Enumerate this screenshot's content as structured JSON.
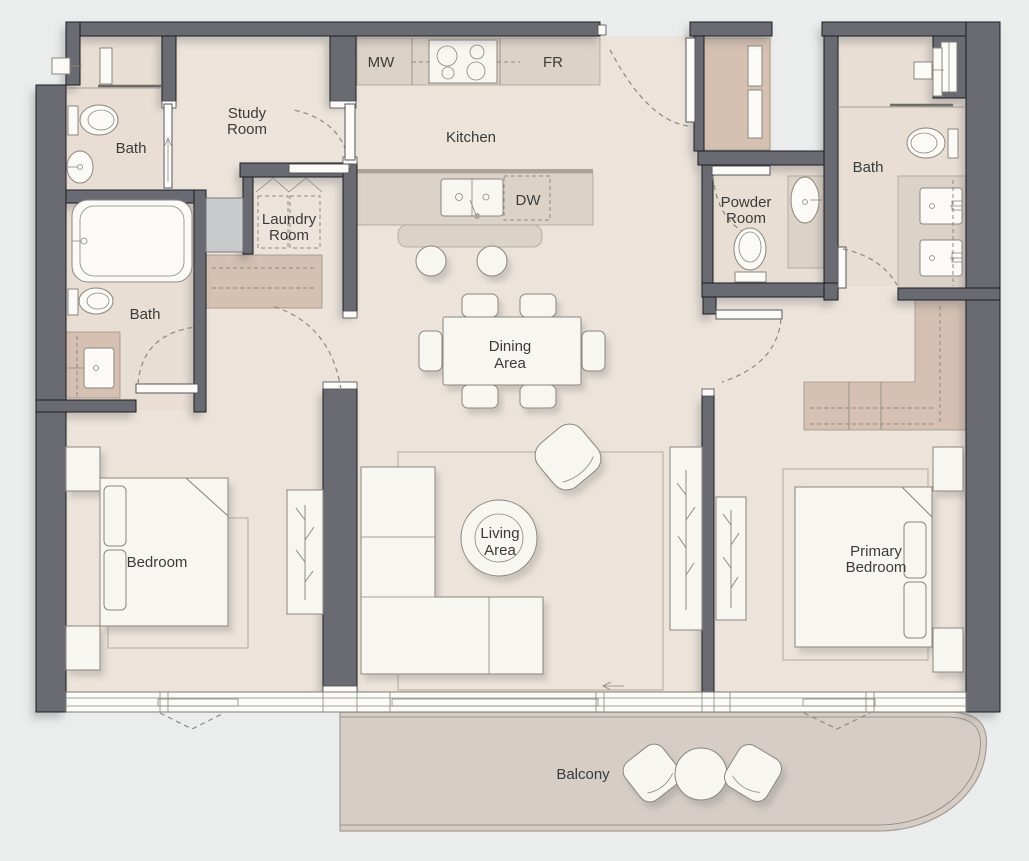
{
  "floorplan": {
    "rooms": {
      "study": [
        "Study",
        "Room"
      ],
      "kitchen": "Kitchen",
      "bath_top_left": "Bath",
      "bath_left": "Bath",
      "bath_right": "Bath",
      "laundry": [
        "Laundry",
        "Room"
      ],
      "powder": [
        "Powder",
        "Room"
      ],
      "dining": [
        "Dining",
        "Area"
      ],
      "living": [
        "Living",
        "Area"
      ],
      "bedroom": "Bedroom",
      "primary_bedroom": [
        "Primary",
        "Bedroom"
      ],
      "balcony": "Balcony"
    },
    "appliances": {
      "microwave": "MW",
      "fridge": "FR",
      "dishwasher": "DW"
    },
    "colors": {
      "background": "#ebedec",
      "wall": "#6a6a72",
      "floor": "#ece4da",
      "bathroom_floor": "#e8ded4",
      "cabinetry_tan": "#d5c0b1",
      "countertop": "#dcd3c8",
      "balcony_floor": "#d5cdc6",
      "furniture": "#f8f6f0"
    }
  }
}
